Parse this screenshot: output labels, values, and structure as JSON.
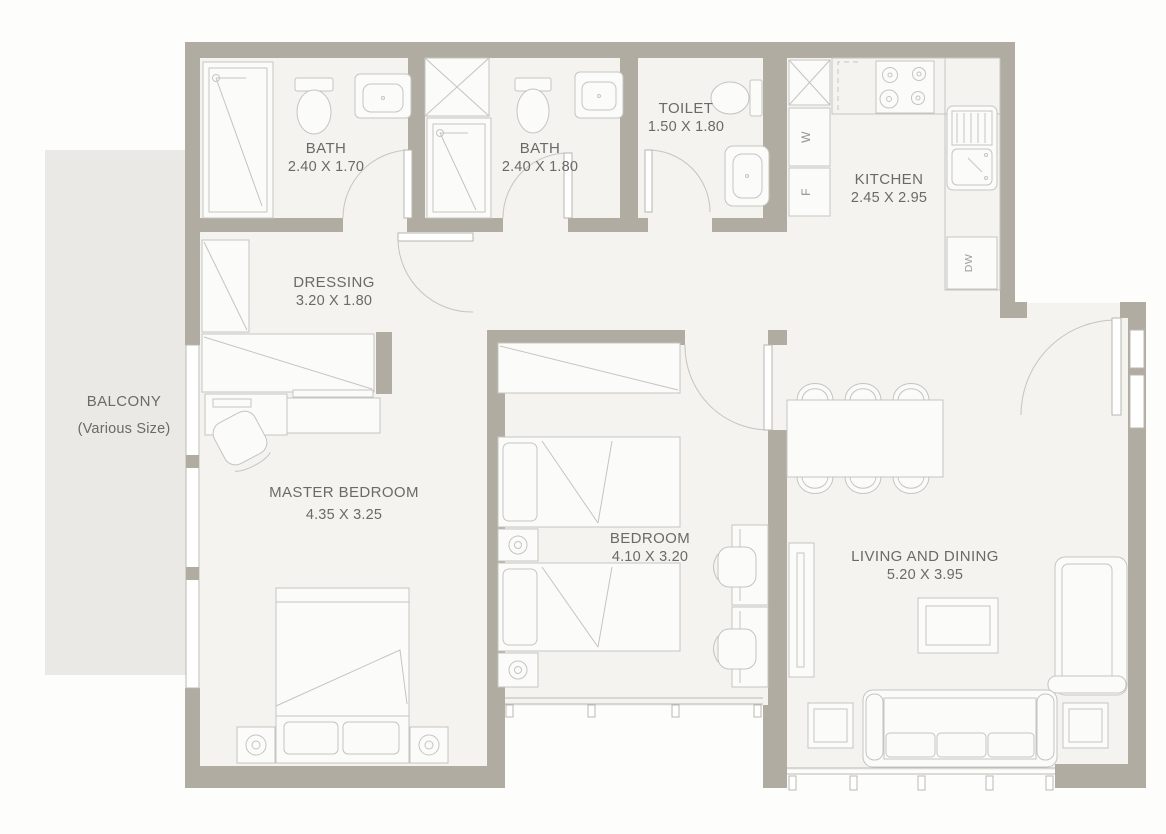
{
  "rooms": {
    "bath1": {
      "name": "BATH",
      "dims": "2.40 X 1.70"
    },
    "bath2": {
      "name": "BATH",
      "dims": "2.40 X 1.80"
    },
    "toilet": {
      "name": "TOILET",
      "dims": "1.50 X 1.80"
    },
    "kitchen": {
      "name": "KITCHEN",
      "dims": "2.45 X 2.95"
    },
    "dressing": {
      "name": "DRESSING",
      "dims": "3.20 X 1.80"
    },
    "balcony": {
      "name": "BALCONY",
      "dims": "(Various Size)"
    },
    "master_bedroom": {
      "name": "MASTER BEDROOM",
      "dims": "4.35 X 3.25"
    },
    "bedroom": {
      "name": "BEDROOM",
      "dims": "4.10 X 3.20"
    },
    "living_dining": {
      "name": "LIVING AND DINING",
      "dims": "5.20 X 3.95"
    }
  },
  "appliances": {
    "washer": "W",
    "fridge": "F",
    "dishwasher": "DW"
  },
  "colors": {
    "wall": "#b0aca1",
    "floor": "#f4f3f0",
    "balcony_floor": "#eae9e6",
    "furniture_line": "#c6c4c0",
    "label_text": "#6a6a67",
    "background": "#fdfdfc"
  }
}
